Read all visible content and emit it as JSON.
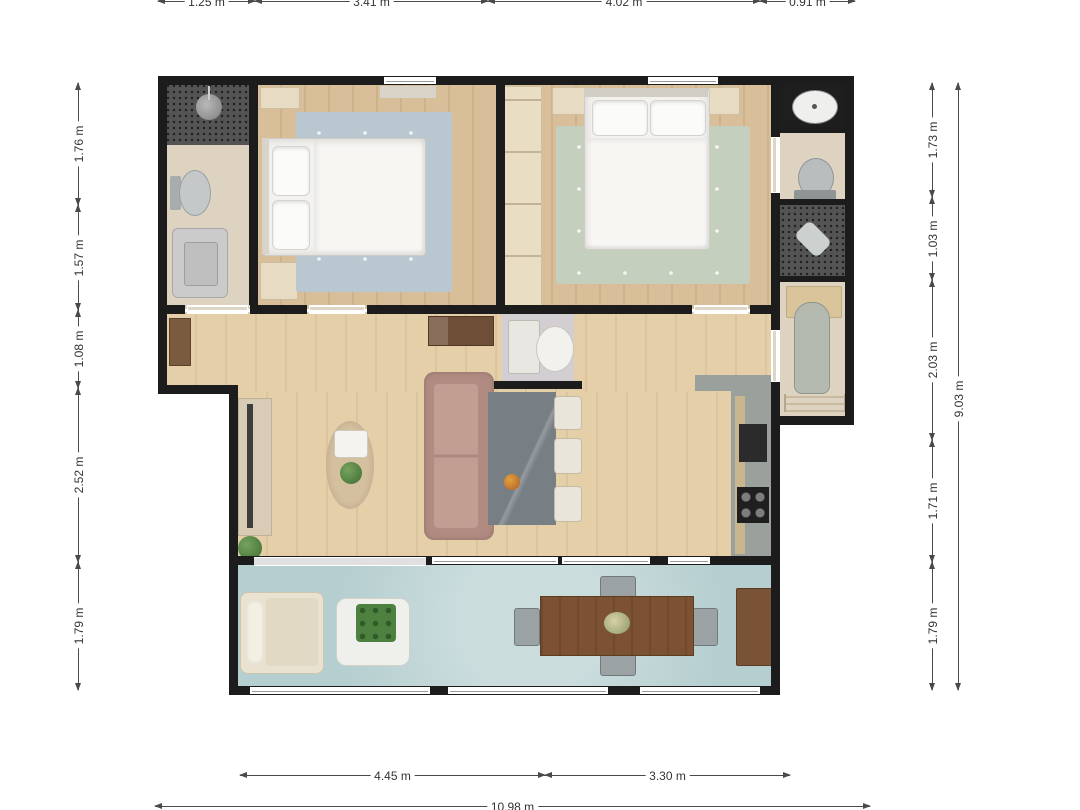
{
  "dimensions": {
    "top": [
      "1.25 m",
      "3.41 m",
      "4.02 m",
      "0.91 m"
    ],
    "left": [
      "1.76 m",
      "1.57 m",
      "1.08 m",
      "2.52 m",
      "1.79 m"
    ],
    "right": [
      "1.73 m",
      "1.03 m",
      "2.03 m",
      "1.71 m",
      "1.79 m"
    ],
    "right_total": "9.03 m",
    "bottom": [
      "4.45 m",
      "3.30 m"
    ],
    "bottom_total": "10.98 m"
  },
  "colors": {
    "wall": "#1c1c1c",
    "wood_bedroom": "#d9bf99",
    "wood_living": "#e4cfa9",
    "tile_beige": "#ded2c0",
    "tile_dark_mosaic": "#545454",
    "balcony_floor": "#b5cecf",
    "rug_blue": "#b9c7d0",
    "rug_green": "#c5cfbd",
    "rug_oval": "#d4bf9e",
    "sofa": "#b18b81",
    "stone_table": "#787f84",
    "kitchen_counter": "#9aa19d",
    "outdoor_table_wood": "#7d5233",
    "dimension_line": "#4a4a4a"
  }
}
